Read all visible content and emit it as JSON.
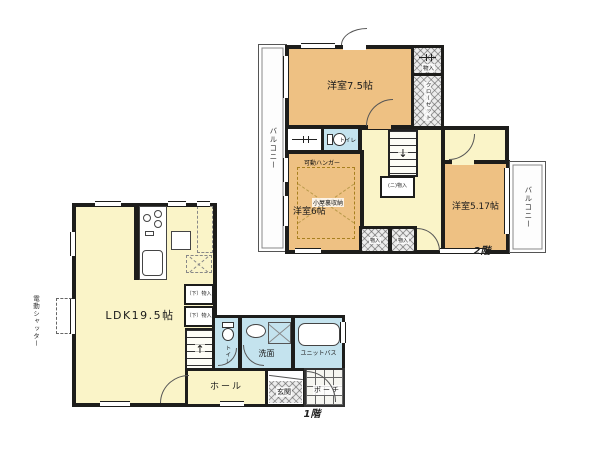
{
  "colors": {
    "wall": "#1d1d1b",
    "bedroom_floor": "#eec183",
    "living_floor": "#faf4c8",
    "wet_area_floor": "#c4e3ee",
    "background": "#ffffff"
  },
  "floor2": {
    "label": "2階",
    "bedroom75": "洋室7.5帖",
    "bedroom6": "洋室6帖",
    "bedroom517": "洋室5.17帖",
    "balcony_left": "バルコニー",
    "balcony_right": "バルコニー",
    "toilet": "トイレ",
    "closet": "クローゼット",
    "storage_small": "物入",
    "storage_ni": "(ニ)物入",
    "storage_bottom1": "物入",
    "storage_bottom2": "物入",
    "attic_storage": "小屋裏収納",
    "movable_hanger": "可動ハンガー",
    "stairs_arrow": "↓"
  },
  "floor1": {
    "label": "1階",
    "ldk": "LDK19.5帖",
    "hall": "ホール",
    "entrance": "玄関",
    "porch": "ポーチ",
    "washroom": "洗面",
    "bath": "ユニットバス",
    "toilet": "トイレ",
    "storage_shita": "（下）物入",
    "electric_shutter": "電動シャッター",
    "stairs_arrow": "↑"
  }
}
